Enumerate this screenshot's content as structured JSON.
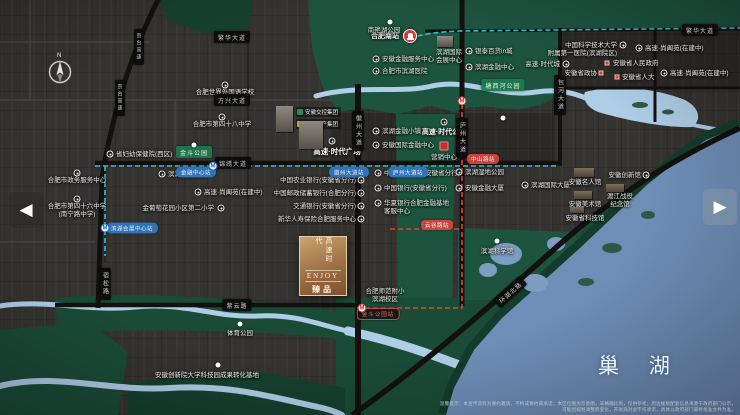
{
  "palette": {
    "lake": "#6f8eb7",
    "river": "#aecde6",
    "metro-blue": "#38c6da",
    "metro-red": "#d8453c",
    "pill-bg": "#0b0b0b",
    "station-blue": "#2f77c4",
    "accent-red": "#d03c35"
  },
  "nav": {
    "left": "◀",
    "right": "▶"
  },
  "lake": {
    "label": "巢  湖"
  },
  "project": {
    "logo_vertical": "高速时代",
    "logo_en": "ENJOY",
    "logo_sub": "臻品",
    "badges": [
      {
        "color": "#2e8b57",
        "text": "安徽交控集团"
      },
      {
        "color": "#c9a43c",
        "text": "高速地产集团"
      }
    ]
  },
  "map": {
    "compass": "N",
    "labels": [
      {
        "t": "省妇幼保健院(西区)",
        "x": 116,
        "y": 151,
        "a": "l"
      },
      {
        "t": "合肥世界外国语学校",
        "x": 225,
        "y": 89,
        "a": "c"
      },
      {
        "t": "合肥市第四十八中学",
        "x": 222,
        "y": 121,
        "a": "c"
      },
      {
        "t": "合肥市政务服务中心",
        "x": 77,
        "y": 177,
        "a": "c"
      },
      {
        "t": "合肥市第四十六中学\n(南宁路中学)",
        "x": 77,
        "y": 203,
        "a": "c"
      },
      {
        "t": "滨湖公安分局",
        "x": 168,
        "y": 171,
        "a": "l"
      },
      {
        "t": "金葡萄花园小区第二小学",
        "x": 214,
        "y": 205,
        "a": "r"
      },
      {
        "t": "高速·尚阖苑(在建中)",
        "x": 204,
        "y": 189,
        "a": "l"
      },
      {
        "t": "高速·时代广场",
        "x": 337,
        "y": 147,
        "a": "c",
        "b": 1,
        "s": 7.5
      },
      {
        "t": "高速·时代公馆",
        "x": 444,
        "y": 129,
        "a": "c",
        "b": 1,
        "s": 7
      },
      {
        "t": "营销中心",
        "x": 444,
        "y": 154,
        "a": "c"
      },
      {
        "t": "中国农业银行(安徽省分行)",
        "x": 356,
        "y": 177,
        "a": "r"
      },
      {
        "t": "中国邮政储蓄银行(合肥分行)",
        "x": 356,
        "y": 190,
        "a": "r"
      },
      {
        "t": "交通银行(安徽省分行)",
        "x": 356,
        "y": 203,
        "a": "r"
      },
      {
        "t": "新华人寿保险合肥服务中心",
        "x": 356,
        "y": 216,
        "a": "r"
      },
      {
        "t": "滨湖金融小镇",
        "x": 382,
        "y": 128,
        "a": "l"
      },
      {
        "t": "安徽国际金融中心",
        "x": 382,
        "y": 142,
        "a": "l"
      },
      {
        "t": "中国工商银行(安徽省分行)",
        "x": 384,
        "y": 170,
        "a": "l"
      },
      {
        "t": "中国银行(安徽省分行)",
        "x": 384,
        "y": 185,
        "a": "l"
      },
      {
        "t": "华夏银行合肥金融基地\n客服中心",
        "x": 384,
        "y": 200,
        "a": "l"
      },
      {
        "t": "滨湖湿地公园",
        "x": 465,
        "y": 169,
        "a": "l"
      },
      {
        "t": "安徽金融大厦",
        "x": 465,
        "y": 185,
        "a": "l"
      },
      {
        "t": "滨湖国际大厦",
        "x": 531,
        "y": 182,
        "a": "l"
      },
      {
        "t": "滨湖科学馆",
        "x": 497,
        "y": 248,
        "a": "c"
      },
      {
        "t": "合肥师范附小\n滨湖校区",
        "x": 385,
        "y": 288,
        "a": "c"
      },
      {
        "t": "安徽创新院大学科技园成果转化基地",
        "x": 207,
        "y": 372,
        "a": "c"
      },
      {
        "t": "体育公园",
        "x": 240,
        "y": 330,
        "a": "c"
      },
      {
        "t": "合肥南站",
        "x": 399,
        "y": 33,
        "a": "r",
        "b": 1,
        "s": 7
      },
      {
        "t": "南艳湖公园",
        "x": 384,
        "y": 27,
        "a": "c"
      },
      {
        "t": "滨湖国际\n会展中心",
        "x": 449,
        "y": 49,
        "a": "c"
      },
      {
        "t": "安徽金融服务中心",
        "x": 382,
        "y": 56,
        "a": "l"
      },
      {
        "t": "合肥市滨湖医院",
        "x": 382,
        "y": 68,
        "a": "l"
      },
      {
        "t": "银泰百货in城",
        "x": 475,
        "y": 48,
        "a": "l"
      },
      {
        "t": "滨湖金融中心",
        "x": 475,
        "y": 64,
        "a": "l"
      },
      {
        "t": "中国科学技术大学\n附属第一医院(滨湖院区)",
        "x": 617,
        "y": 42,
        "a": "r"
      },
      {
        "t": "高速·尚阖苑(在建中)",
        "x": 645,
        "y": 45,
        "a": "l"
      },
      {
        "t": "高速·尚阖苑(在建中)",
        "x": 670,
        "y": 70,
        "a": "l"
      },
      {
        "t": "安徽省人民政府",
        "x": 613,
        "y": 60,
        "a": "l"
      },
      {
        "t": "安徽省政协",
        "x": 597,
        "y": 70,
        "a": "r"
      },
      {
        "t": "安徽省人大",
        "x": 622,
        "y": 74,
        "a": "l"
      },
      {
        "t": "高速·时代城",
        "x": 560,
        "y": 61,
        "a": "r"
      },
      {
        "t": "安徽名人馆",
        "x": 585,
        "y": 179,
        "a": "c"
      },
      {
        "t": "安徽创新馆",
        "x": 641,
        "y": 172,
        "a": "r"
      },
      {
        "t": "渡江战役\n纪念馆",
        "x": 620,
        "y": 193,
        "a": "c"
      },
      {
        "t": "安徽美术馆",
        "x": 585,
        "y": 201,
        "a": "c"
      },
      {
        "t": "安徽省科技馆",
        "x": 585,
        "y": 215,
        "a": "c"
      }
    ],
    "pills": [
      {
        "t": "繁华大道",
        "x": 232,
        "y": 37,
        "k": "road"
      },
      {
        "t": "方兴大道",
        "x": 232,
        "y": 100,
        "k": "road"
      },
      {
        "t": "锦绣大道",
        "x": 233,
        "y": 163,
        "k": "road"
      },
      {
        "t": "紫云路",
        "x": 237,
        "y": 305,
        "k": "road"
      },
      {
        "t": "繁华大道",
        "x": 700,
        "y": 30,
        "k": "road"
      },
      {
        "t": "徽州大道",
        "x": 358,
        "y": 131,
        "k": "road",
        "v": 1
      },
      {
        "t": "庐州大道",
        "x": 462,
        "y": 138,
        "k": "road",
        "v": 1
      },
      {
        "t": "包河大道",
        "x": 560,
        "y": 95,
        "k": "road",
        "v": 1
      },
      {
        "t": "宿松路",
        "x": 105,
        "y": 284,
        "k": "road",
        "v": 1
      },
      {
        "t": "京台高速",
        "x": 139,
        "y": 47,
        "k": "road",
        "v": 1,
        "s": 5
      },
      {
        "t": "京台高速",
        "x": 120,
        "y": 98,
        "k": "road",
        "v": 1,
        "s": 5
      },
      {
        "t": "环湖北路",
        "x": 510,
        "y": 292,
        "k": "road",
        "rot": -42
      },
      {
        "t": "金融中心站",
        "x": 196,
        "y": 172,
        "k": "sblue"
      },
      {
        "t": "徽州大道站",
        "x": 349,
        "y": 172,
        "k": "sblue"
      },
      {
        "t": "庐州大道站",
        "x": 408,
        "y": 172,
        "k": "sblue"
      },
      {
        "t": "滨湖会展中心站",
        "x": 132,
        "y": 228,
        "k": "sblue"
      },
      {
        "t": "中山路站",
        "x": 483,
        "y": 159,
        "k": "sred"
      },
      {
        "t": "云谷路站",
        "x": 437,
        "y": 225,
        "k": "sred"
      },
      {
        "t": "金斗公园站",
        "x": 378,
        "y": 314,
        "k": "sredo"
      },
      {
        "t": "金斗公园",
        "x": 194,
        "y": 152,
        "k": "green"
      },
      {
        "t": "塘西河公园",
        "x": 503,
        "y": 85,
        "k": "green"
      }
    ],
    "markers": [
      {
        "k": "poi",
        "x": 110,
        "y": 154
      },
      {
        "k": "poi",
        "x": 225,
        "y": 85
      },
      {
        "k": "poi",
        "x": 222,
        "y": 117
      },
      {
        "k": "poi",
        "x": 77,
        "y": 173
      },
      {
        "k": "poi",
        "x": 77,
        "y": 199
      },
      {
        "k": "poi",
        "x": 162,
        "y": 174
      },
      {
        "k": "poi",
        "x": 221,
        "y": 208
      },
      {
        "k": "poi",
        "x": 198,
        "y": 192
      },
      {
        "k": "poi",
        "x": 332,
        "y": 141
      },
      {
        "k": "poi",
        "x": 444,
        "y": 122
      },
      {
        "k": "poi",
        "x": 361,
        "y": 180
      },
      {
        "k": "poi",
        "x": 361,
        "y": 193
      },
      {
        "k": "poi",
        "x": 361,
        "y": 206
      },
      {
        "k": "poi",
        "x": 361,
        "y": 219
      },
      {
        "k": "poi",
        "x": 376,
        "y": 131
      },
      {
        "k": "poi",
        "x": 376,
        "y": 145
      },
      {
        "k": "poi",
        "x": 378,
        "y": 173
      },
      {
        "k": "poi",
        "x": 378,
        "y": 188
      },
      {
        "k": "poi",
        "x": 378,
        "y": 203
      },
      {
        "k": "poi",
        "x": 459,
        "y": 172
      },
      {
        "k": "poi",
        "x": 459,
        "y": 188
      },
      {
        "k": "poi",
        "x": 525,
        "y": 185
      },
      {
        "k": "poi",
        "x": 623,
        "y": 45
      },
      {
        "k": "poi",
        "x": 639,
        "y": 48
      },
      {
        "k": "poi",
        "x": 664,
        "y": 73
      },
      {
        "k": "poi",
        "x": 566,
        "y": 64
      },
      {
        "k": "poi",
        "x": 646,
        "y": 175
      },
      {
        "k": "poi",
        "x": 469,
        "y": 51
      },
      {
        "k": "poi",
        "x": 469,
        "y": 67
      },
      {
        "k": "poi",
        "x": 376,
        "y": 59
      },
      {
        "k": "poi",
        "x": 376,
        "y": 71
      },
      {
        "k": "dot",
        "x": 194,
        "y": 145
      },
      {
        "k": "dot",
        "x": 390,
        "y": 22
      },
      {
        "k": "dot",
        "x": 218,
        "y": 365
      },
      {
        "k": "dot",
        "x": 240,
        "y": 324
      },
      {
        "k": "dot",
        "x": 497,
        "y": 241
      },
      {
        "k": "dot",
        "x": 503,
        "y": 118
      },
      {
        "k": "redsq",
        "x": 607,
        "y": 63
      },
      {
        "k": "redsq",
        "x": 601,
        "y": 73
      },
      {
        "k": "redsq",
        "x": 617,
        "y": 77
      },
      {
        "k": "redbox",
        "x": 444,
        "y": 146
      },
      {
        "k": "mblue",
        "x": 213,
        "y": 166,
        "g": "M"
      },
      {
        "k": "mblue",
        "x": 105,
        "y": 228,
        "g": "M"
      },
      {
        "k": "mred",
        "x": 462,
        "y": 101,
        "g": "M"
      },
      {
        "k": "mred",
        "x": 362,
        "y": 308,
        "g": "M"
      },
      {
        "k": "train",
        "x": 410,
        "y": 36
      }
    ],
    "buildings": [
      {
        "x": 276,
        "y": 106,
        "w": 17,
        "h": 26
      },
      {
        "x": 299,
        "y": 121,
        "w": 24,
        "h": 28
      },
      {
        "x": 437,
        "y": 36,
        "w": 16,
        "h": 11
      },
      {
        "x": 574,
        "y": 168,
        "w": 20,
        "h": 9,
        "v": "tan"
      },
      {
        "x": 606,
        "y": 184,
        "w": 18,
        "h": 8,
        "v": "tan"
      },
      {
        "x": 574,
        "y": 191,
        "w": 18,
        "h": 8,
        "v": "tan"
      },
      {
        "x": 570,
        "y": 207,
        "w": 14,
        "h": 6,
        "v": "tan"
      }
    ]
  },
  "disclaimer": [
    "温馨提示：本宣传资料为要约邀请，不构成要约或承诺；本区位图为示意图，非精确比例，仅供参考；周边规划配套信息来源于政府部门公示，",
    "可能因规划调整而变化，开发商对此不作承诺，具体以政府部门最终批准文件为准。"
  ]
}
